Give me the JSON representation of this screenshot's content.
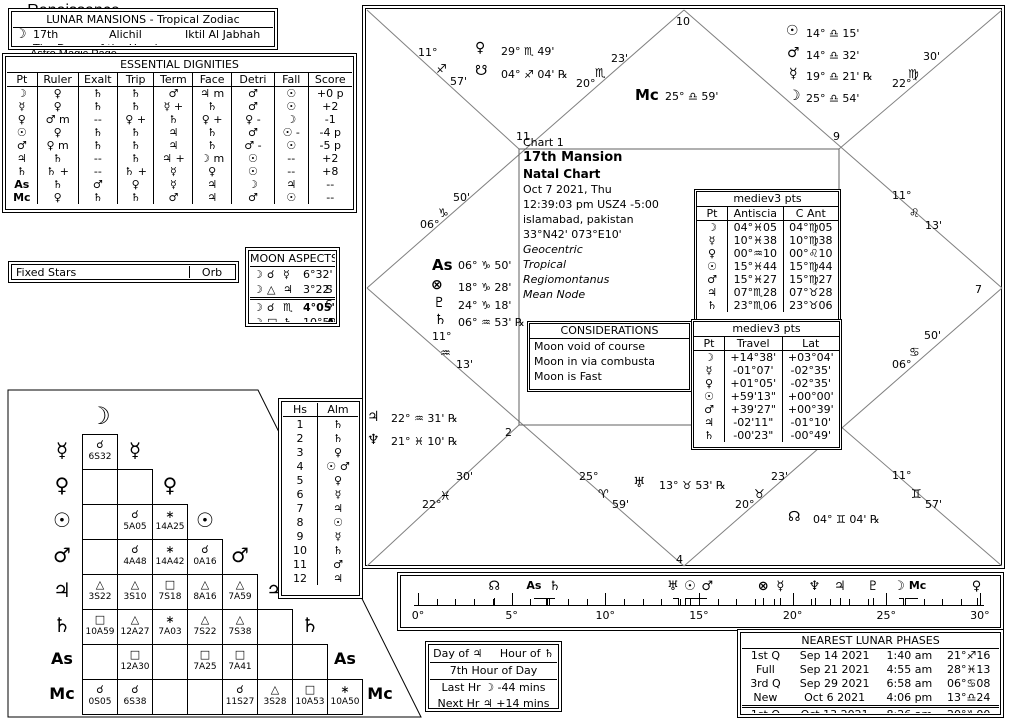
{
  "lunar_mansions": {
    "title": "LUNAR MANSIONS - Tropical Zodiac",
    "moon_glyph": "☽",
    "number": "17th",
    "name": "Alichil",
    "arabic_name": "Iktil Al Jabhah",
    "meaning": "The Dome of the Head"
  },
  "dignities": {
    "title": "ESSENTIAL DIGNITIES",
    "headers": [
      "Pt",
      "Ruler",
      "Exalt",
      "Trip",
      "Term",
      "Face",
      "Detri",
      "Fall",
      "Score"
    ],
    "rows": [
      [
        "☽",
        "♀",
        "♄",
        "♄",
        "♂",
        "♃ m",
        "♂",
        "☉",
        "+0 p"
      ],
      [
        "☿",
        "♀",
        "♄",
        "♄",
        "☿ +",
        "♄",
        "♂",
        "☉",
        "+2"
      ],
      [
        "♀",
        "♂ m",
        "--",
        "♀ +",
        "♄",
        "♀ +",
        "♀ -",
        "☽",
        "-1"
      ],
      [
        "☉",
        "♀",
        "♄",
        "♄",
        "♃",
        "♄",
        "♂",
        "☉ -",
        "-4 p"
      ],
      [
        "♂",
        "♀ m",
        "♄",
        "♄",
        "♃",
        "♄",
        "♂ -",
        "☉",
        "-5 p"
      ],
      [
        "♃",
        "♄",
        "--",
        "♄",
        "♃ +",
        "☽ m",
        "☉",
        "--",
        "+2"
      ],
      [
        "♄",
        "♄ +",
        "--",
        "♄ +",
        "☿",
        "♀",
        "☉",
        "--",
        "+8"
      ],
      [
        "As",
        "♄",
        "♂",
        "♀",
        "☿",
        "♃",
        "☽",
        "♃",
        "--"
      ],
      [
        "Mc",
        "♀",
        "♄",
        "♄",
        "♂",
        "♃",
        "♂",
        "☉",
        "--"
      ]
    ]
  },
  "fixed_stars": {
    "label": "Fixed Stars",
    "orb_label": "Orb"
  },
  "moon_aspects": {
    "title": "MOON ASPECTS",
    "rows": [
      {
        "p1": "☽",
        "asp": "☌",
        "p2": "☿",
        "orb": "6°32' S",
        "bold": false,
        "sep": false
      },
      {
        "p1": "☽",
        "asp": "△",
        "p2": "♃",
        "orb": "3°22' S",
        "bold": false,
        "sep": false
      },
      {
        "p1": "☽",
        "asp": "☌",
        "p2": "♏",
        "orb": "4°05' A",
        "bold": true,
        "sep": true
      },
      {
        "p1": "☽",
        "asp": "□",
        "p2": "♄",
        "orb": "10°59' A",
        "bold": false,
        "sep": false
      }
    ]
  },
  "aspectarian": {
    "planets": [
      "☽",
      "☿",
      "♀",
      "☉",
      "♂",
      "♃",
      "♄",
      "As",
      "Mc"
    ],
    "cells": [
      [
        {
          "a": "☌",
          "v": "6S32"
        }
      ],
      [
        null,
        null
      ],
      [
        null,
        {
          "a": "☌",
          "v": "5A05"
        },
        {
          "a": "∗",
          "v": "14A25"
        }
      ],
      [
        null,
        {
          "a": "☌",
          "v": "4A48"
        },
        {
          "a": "∗",
          "v": "14A42"
        },
        {
          "a": "☌",
          "v": "0A16"
        }
      ],
      [
        {
          "a": "△",
          "v": "3S22"
        },
        {
          "a": "△",
          "v": "3S10"
        },
        {
          "a": "□",
          "v": "7S18"
        },
        {
          "a": "△",
          "v": "8A16"
        },
        {
          "a": "△",
          "v": "7A59"
        }
      ],
      [
        {
          "a": "□",
          "v": "10A59"
        },
        {
          "a": "△",
          "v": "12A27"
        },
        {
          "a": "∗",
          "v": "7A03"
        },
        {
          "a": "△",
          "v": "7S22"
        },
        {
          "a": "△",
          "v": "7S38"
        },
        null
      ],
      [
        null,
        {
          "a": "□",
          "v": "12A30"
        },
        null,
        {
          "a": "□",
          "v": "7A25"
        },
        {
          "a": "□",
          "v": "7A41"
        },
        null,
        null
      ],
      [
        {
          "a": "☌",
          "v": "0S05"
        },
        {
          "a": "☌",
          "v": "6S38"
        },
        null,
        null,
        {
          "a": "☌",
          "v": "11S27"
        },
        {
          "a": "△",
          "v": "3S28"
        },
        {
          "a": "□",
          "v": "10A53"
        },
        {
          "a": "∗",
          "v": "10A50"
        }
      ]
    ]
  },
  "hs_alm": {
    "headers": [
      "Hs",
      "Alm"
    ],
    "rows": [
      [
        "1",
        "♄"
      ],
      [
        "2",
        "♄"
      ],
      [
        "3",
        "♀"
      ],
      [
        "4",
        "☉ ♂"
      ],
      [
        "5",
        "♀"
      ],
      [
        "6",
        "☿"
      ],
      [
        "7",
        "♃"
      ],
      [
        "8",
        "☉"
      ],
      [
        "9",
        "☿"
      ],
      [
        "10",
        "♄"
      ],
      [
        "11",
        "♂"
      ],
      [
        "12",
        "♃"
      ]
    ]
  },
  "chart": {
    "info": {
      "chart_label": "Chart 1",
      "title": "17th Mansion",
      "subtitle": "Natal Chart",
      "date": "Oct 7 2021, Thu",
      "time": "12:39:03 pm  USZ4 -5:00",
      "place": "islamabad, pakistan",
      "coords": "33°N42' 073°E10'",
      "settings": [
        "Geocentric",
        "Tropical",
        "Regiomontanus",
        "Mean Node"
      ]
    },
    "house_numbers": [
      [
        "10",
        313,
        9
      ],
      [
        "11",
        153,
        124
      ],
      [
        "9",
        470,
        124
      ],
      [
        "7",
        612,
        277
      ],
      [
        "5",
        472,
        427
      ],
      [
        "4",
        313,
        547
      ],
      [
        "2",
        142,
        420
      ]
    ],
    "cusps": [
      {
        "house": "1",
        "parts": [
          [
            "06°",
            57,
            212
          ],
          [
            "♑",
            75,
            200
          ],
          [
            "50'",
            90,
            185
          ]
        ]
      },
      {
        "house": "2",
        "parts": [
          [
            "11°",
            69,
            324
          ],
          [
            "♒",
            77,
            340
          ],
          [
            "13'",
            93,
            352
          ]
        ]
      },
      {
        "house": "3",
        "parts": [
          [
            "22°",
            59,
            492
          ],
          [
            "♓",
            77,
            483
          ],
          [
            "30'",
            93,
            464
          ]
        ]
      },
      {
        "house": "4",
        "parts": [
          [
            "25°",
            216,
            464
          ],
          [
            "♈",
            235,
            481
          ],
          [
            "59'",
            249,
            492
          ]
        ]
      },
      {
        "house": "5",
        "parts": [
          [
            "23'",
            408,
            464
          ],
          [
            "♉",
            391,
            481
          ],
          [
            "20°",
            372,
            492
          ]
        ]
      },
      {
        "house": "6",
        "parts": [
          [
            "11°",
            529,
            463
          ],
          [
            "♊",
            548,
            481
          ],
          [
            "57'",
            562,
            492
          ]
        ]
      },
      {
        "house": "7",
        "parts": [
          [
            "50'",
            561,
            323
          ],
          [
            "♋",
            546,
            339
          ],
          [
            "06°",
            529,
            352
          ]
        ]
      },
      {
        "house": "8",
        "parts": [
          [
            "11°",
            529,
            183
          ],
          [
            "♌",
            546,
            200
          ],
          [
            "13'",
            562,
            213
          ]
        ]
      },
      {
        "house": "9",
        "parts": [
          [
            "22°",
            529,
            71
          ],
          [
            "♍",
            545,
            61
          ],
          [
            "30'",
            560,
            44
          ]
        ]
      },
      {
        "house": "11",
        "parts": [
          [
            "23'",
            248,
            46
          ],
          [
            "♏",
            232,
            60
          ],
          [
            "20°",
            213,
            71
          ]
        ]
      },
      {
        "house": "12",
        "parts": [
          [
            "11°",
            55,
            40
          ],
          [
            "♐",
            73,
            56
          ],
          [
            "57'",
            87,
            69
          ]
        ]
      }
    ],
    "mc_label": {
      "glyph": "Mc",
      "text": "25° ♎ 59'"
    },
    "planets": [
      {
        "glyph": "♀",
        "x": 112,
        "y": 34,
        "text": "29° ♏ 49'",
        "tx": 138,
        "ty": 39
      },
      {
        "glyph": "☋",
        "x": 112,
        "y": 57,
        "text": "04° ♐ 04' ℞",
        "tx": 138,
        "ty": 62
      },
      {
        "glyph": "☉",
        "x": 423,
        "y": 17,
        "text": "14° ♎ 15'",
        "tx": 443,
        "ty": 21
      },
      {
        "glyph": "♂",
        "x": 424,
        "y": 39,
        "text": "14° ♎ 32'",
        "tx": 443,
        "ty": 43
      },
      {
        "glyph": "☿",
        "x": 426,
        "y": 60,
        "text": "19° ♎ 21' ℞",
        "tx": 443,
        "ty": 64
      },
      {
        "glyph": "☽",
        "x": 425,
        "y": 82,
        "text": "25° ♎ 54'",
        "tx": 443,
        "ty": 86
      },
      {
        "glyph": "As",
        "x": 69,
        "y": 250,
        "text": "06° ♑ 50'",
        "tx": 95,
        "ty": 253
      },
      {
        "glyph": "⊗",
        "x": 68,
        "y": 271,
        "text": "18° ♑ 28'",
        "tx": 95,
        "ty": 275
      },
      {
        "glyph": "♇",
        "x": 70,
        "y": 289,
        "text": "24° ♑ 18'",
        "tx": 95,
        "ty": 293
      },
      {
        "glyph": "♄",
        "x": 71,
        "y": 306,
        "text": "06° ♒ 53' ℞",
        "tx": 95,
        "ty": 310
      },
      {
        "glyph": "♃",
        "x": 4,
        "y": 403,
        "text": "22° ♒ 31' ℞",
        "tx": 28,
        "ty": 406
      },
      {
        "glyph": "♆",
        "x": 4,
        "y": 426,
        "text": "21° ♓ 10' ℞",
        "tx": 28,
        "ty": 429
      },
      {
        "glyph": "♅",
        "x": 270,
        "y": 469,
        "text": "13° ♉ 53' ℞",
        "tx": 296,
        "ty": 473
      },
      {
        "glyph": "☊",
        "x": 425,
        "y": 503,
        "text": "04° ♊ 04' ℞",
        "tx": 450,
        "ty": 507
      }
    ],
    "mediev1": {
      "title": "mediev3 pts",
      "headers": [
        "Pt",
        "Antiscia",
        "C Ant"
      ],
      "rows": [
        [
          "☽",
          "04°♓05",
          "04°♍05"
        ],
        [
          "☿",
          "10°♓38",
          "10°♍38"
        ],
        [
          "♀",
          "00°♒10",
          "00°♌10"
        ],
        [
          "☉",
          "15°♓44",
          "15°♍44"
        ],
        [
          "♂",
          "15°♓27",
          "15°♍27"
        ],
        [
          "♃",
          "07°♏28",
          "07°♉28"
        ],
        [
          "♄",
          "23°♏06",
          "23°♉06"
        ]
      ]
    },
    "considerations": {
      "title": "CONSIDERATIONS",
      "items": [
        "Moon void of course",
        "Moon in via combusta",
        "Moon is Fast"
      ]
    },
    "mediev2": {
      "title": "mediev3 pts",
      "headers": [
        "Pt",
        "Travel",
        "Lat"
      ],
      "rows": [
        [
          "☽",
          "+14°38'",
          "+03°04'"
        ],
        [
          "☿",
          "-01°07'",
          "-02°35'"
        ],
        [
          "♀",
          "+01°05'",
          "-02°35'"
        ],
        [
          "☉",
          "+59'13\"",
          "+00°00'"
        ],
        [
          "♂",
          "+39'27\"",
          "+00°39'"
        ],
        [
          "♃",
          "-02'11\"",
          "-01°10'"
        ],
        [
          "♄",
          "-00'23\"",
          "-00°49'"
        ]
      ]
    }
  },
  "ruler": {
    "min": 0,
    "max": 30,
    "major_step": 5,
    "labels": [
      "0°",
      "5°",
      "10°",
      "15°",
      "20°",
      "25°",
      "30°"
    ],
    "markers": [
      [
        "☊",
        4.07,
        0
      ],
      [
        "As",
        6.83,
        -12
      ],
      [
        "♄",
        6.88,
        8
      ],
      [
        "♅",
        13.88,
        -5
      ],
      [
        "☉",
        14.25,
        5
      ],
      [
        "♂",
        14.53,
        17
      ],
      [
        "⊗",
        18.43,
        0
      ],
      [
        "☿",
        19.35,
        0
      ],
      [
        "♆",
        21.17,
        0
      ],
      [
        "♃",
        22.52,
        0
      ],
      [
        "♇",
        24.3,
        0
      ],
      [
        "☽",
        25.9,
        -4
      ],
      [
        "Mc",
        25.98,
        13
      ],
      [
        "♀",
        29.82,
        0
      ]
    ]
  },
  "day_hour": {
    "day_label": "Day of",
    "day_glyph": "♃",
    "hour_label": "Hour of",
    "hour_glyph": "♄",
    "hour_line": "7th Hour of Day",
    "last_hr": "Last Hr ☽  -44 mins",
    "next_hr": "Next Hr ♃  +14 mins"
  },
  "branding": {
    "line1": "Renaissance",
    "line2": "Astrology",
    "line3": "Astro Magic Page"
  },
  "lunar_phases": {
    "title": "NEAREST LUNAR PHASES",
    "rows": [
      [
        "1st Q",
        "Sep 14 2021",
        "1:40 am",
        "21°♐16"
      ],
      [
        "Full",
        "Sep 21 2021",
        "4:55 am",
        "28°♓13"
      ],
      [
        "3rd Q",
        "Sep 29 2021",
        "6:58 am",
        "06°♋08"
      ],
      [
        "New",
        "Oct 6 2021",
        "4:06 pm",
        "13°♎24"
      ],
      [
        "1st Q",
        "Oct 13 2021",
        "8:26 am",
        "20°♑00"
      ]
    ]
  }
}
